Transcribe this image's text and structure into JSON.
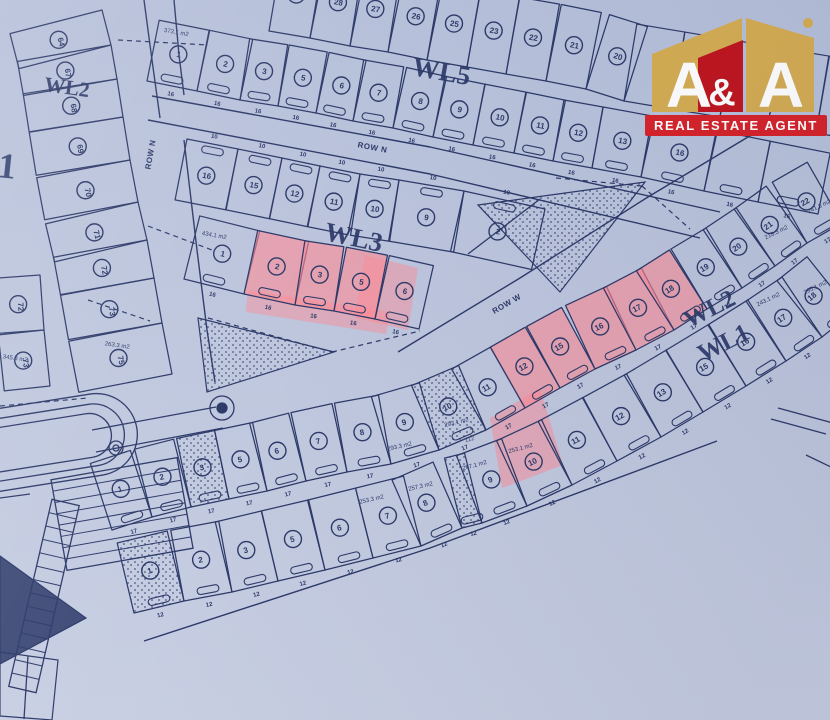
{
  "logo": {
    "a1": "A",
    "amp": "&",
    "a2": "A",
    "banner": "REAL ESTATE AGENT",
    "gold": "#d4ac52",
    "red": "#bf161f",
    "banner_red": "#d6232b",
    "text_color": "#ffffff"
  },
  "map": {
    "bg_top": "#b5bfd9",
    "bg_bottom": "#c8cfe3",
    "ink": "#2d3a69",
    "highlight": "#ff8a94",
    "block_labels": [
      {
        "text": "WL2",
        "x": 66,
        "y": 94,
        "rot": 8,
        "size": 21
      },
      {
        "text": "WL5",
        "x": 440,
        "y": 80,
        "rot": 10,
        "size": 27
      },
      {
        "text": "WL3",
        "x": 352,
        "y": 246,
        "rot": 12,
        "size": 27
      },
      {
        "text": "WL2",
        "x": 713,
        "y": 316,
        "rot": -27,
        "size": 25
      },
      {
        "text": "WL1",
        "x": 727,
        "y": 350,
        "rot": -27,
        "size": 25
      }
    ],
    "misc_labels": [
      {
        "text": "1",
        "x": 6,
        "y": 178,
        "rot": 6,
        "size": 36
      }
    ],
    "road_labels": [
      {
        "text": "ROW N",
        "x": 372,
        "y": 150,
        "rot": 11
      },
      {
        "text": "ROW N",
        "x": 153,
        "y": 155,
        "rot": -80
      },
      {
        "text": "ROW W",
        "x": 508,
        "y": 306,
        "rot": -30
      }
    ],
    "area_labels": [
      {
        "text": "373.1 m2",
        "x": 176,
        "y": 34,
        "rot": 10
      },
      {
        "text": "434.1 m2",
        "x": 214,
        "y": 237,
        "rot": 10
      },
      {
        "text": "293.3 m2",
        "x": 400,
        "y": 448,
        "rot": -13
      },
      {
        "text": "293.1 m2",
        "x": 457,
        "y": 424,
        "rot": -14
      },
      {
        "text": "112",
        "x": 470,
        "y": 441,
        "rot": -14
      },
      {
        "text": "253.3 m2",
        "x": 372,
        "y": 501,
        "rot": -13
      },
      {
        "text": "257.3 m2",
        "x": 421,
        "y": 488,
        "rot": -13
      },
      {
        "text": "257.1 m2",
        "x": 475,
        "y": 467,
        "rot": -15
      },
      {
        "text": "253.1 m2",
        "x": 521,
        "y": 450,
        "rot": -15
      },
      {
        "text": "263.3 m2",
        "x": 117,
        "y": 347,
        "rot": 8
      },
      {
        "text": "345.3 m2",
        "x": 15,
        "y": 360,
        "rot": 8
      },
      {
        "text": "218.3 m2",
        "x": 777,
        "y": 234,
        "rot": -26
      },
      {
        "text": "241.3 m2",
        "x": 820,
        "y": 208,
        "rot": -26
      },
      {
        "text": "295.1 m2",
        "x": 816,
        "y": 289,
        "rot": -26
      },
      {
        "text": "243.1 m2",
        "x": 769,
        "y": 301,
        "rot": -26
      }
    ],
    "rows": [
      {
        "name": "top-row",
        "spine": [
          [
            269,
            31
          ],
          [
            310,
            38
          ],
          [
            350,
            46
          ],
          [
            388,
            52
          ],
          [
            427,
            60
          ],
          [
            467,
            67
          ],
          [
            506,
            74
          ],
          [
            546,
            81
          ],
          [
            586,
            89
          ],
          [
            624,
            101
          ],
          [
            672,
            109
          ],
          [
            720,
            117
          ],
          [
            768,
            125
          ],
          [
            816,
            133
          ],
          [
            862,
            141
          ]
        ],
        "depth": 78,
        "sign": 1,
        "brackets": false,
        "dim": "",
        "nums": [
          "29",
          "28",
          "27",
          "26",
          "25",
          "23",
          "22",
          "21",
          "20",
          "",
          "",
          "",
          "",
          ""
        ],
        "hl": [],
        "st": []
      },
      {
        "name": "wl5-row",
        "spine": [
          [
            147,
            81
          ],
          [
            197,
            91
          ],
          [
            240,
            100
          ],
          [
            278,
            106
          ],
          [
            316,
            113
          ],
          [
            353,
            121
          ],
          [
            393,
            128
          ],
          [
            433,
            137
          ],
          [
            473,
            145
          ],
          [
            514,
            153
          ],
          [
            553,
            161
          ],
          [
            592,
            168
          ],
          [
            641,
            177
          ],
          [
            704,
            191
          ],
          [
            758,
            202
          ],
          [
            818,
            214
          ]
        ],
        "depth": 62,
        "sign": 1,
        "brackets": true,
        "dim": "16",
        "nums": [
          "1",
          "2",
          "3",
          "5",
          "6",
          "7",
          "8",
          "9",
          "10",
          "11",
          "12",
          "13",
          "16",
          "",
          ""
        ],
        "hl": [],
        "st": []
      },
      {
        "name": "wl3-upper",
        "spine": [
          [
            187,
            139
          ],
          [
            238,
            149
          ],
          [
            282,
            158
          ],
          [
            320,
            166
          ],
          [
            360,
            174
          ],
          [
            399,
            180
          ],
          [
            464,
            191
          ],
          [
            545,
            209
          ]
        ],
        "depth": 62,
        "sign": -1,
        "brackets": true,
        "dim": "10",
        "nums": [
          "16",
          "15",
          "12",
          "11",
          "10",
          "9",
          "2"
        ],
        "hl": [],
        "st": []
      },
      {
        "name": "wl3-lower",
        "spine": [
          [
            184,
            279
          ],
          [
            244,
            294
          ],
          [
            295,
            305
          ],
          [
            334,
            311
          ],
          [
            375,
            319
          ],
          [
            419,
            329
          ]
        ],
        "depth": 65,
        "sign": 1,
        "brackets": true,
        "dim": "16",
        "nums": [
          "1",
          "2",
          "3",
          "5",
          "6"
        ],
        "hl": [
          1,
          2,
          3
        ],
        "st": []
      },
      {
        "name": "left-column",
        "spine": [
          [
            102,
            10
          ],
          [
            111,
            45
          ],
          [
            117,
            79
          ],
          [
            123,
            117
          ],
          [
            130,
            160
          ],
          [
            138,
            202
          ],
          [
            147,
            240
          ],
          [
            154,
            278
          ],
          [
            162,
            323
          ],
          [
            172,
            374
          ]
        ],
        "depth": 95,
        "sign": -1,
        "brackets": false,
        "dim": "",
        "nums": [
          "64",
          "67",
          "68",
          "69",
          "70",
          "71",
          "72",
          "73",
          "75"
        ],
        "hl": [],
        "st": []
      },
      {
        "name": "far-left-column",
        "spine": [
          [
            40,
            275
          ],
          [
            44,
            330
          ],
          [
            50,
            386
          ]
        ],
        "depth": 46,
        "sign": -1,
        "brackets": false,
        "dim": "",
        "nums": [
          "72",
          "73"
        ],
        "hl": [],
        "st": []
      },
      {
        "name": "wl2-row",
        "spine": [
          [
            112,
            530
          ],
          [
            152,
            517
          ],
          [
            191,
            507
          ],
          [
            229,
            499
          ],
          [
            267,
            491
          ],
          [
            306,
            481
          ],
          [
            347,
            472
          ],
          [
            391,
            464
          ],
          [
            439,
            450
          ],
          [
            486,
            430
          ],
          [
            525,
            408
          ],
          [
            560,
            388
          ],
          [
            595,
            369
          ],
          [
            636,
            350
          ],
          [
            674,
            330
          ],
          [
            707,
            309
          ],
          [
            742,
            288
          ],
          [
            775,
            266
          ],
          [
            807,
            243
          ],
          [
            842,
            223
          ]
        ],
        "depth": 70,
        "sign": 1,
        "brackets": true,
        "dim": "17",
        "nums": [
          "1",
          "2",
          "3",
          "5",
          "6",
          "7",
          "8",
          "9",
          "10",
          "11",
          "12",
          "15",
          "16",
          "17",
          "18",
          "19",
          "20",
          "21",
          "22"
        ],
        "hl": [
          10,
          11,
          12,
          13,
          14
        ],
        "st": [
          2,
          8
        ]
      },
      {
        "name": "wl1-row",
        "spine": [
          [
            134,
            613
          ],
          [
            184,
            601
          ],
          [
            232,
            592
          ],
          [
            278,
            581
          ],
          [
            325,
            570
          ],
          [
            373,
            558
          ],
          [
            421,
            546
          ],
          [
            462,
            528
          ],
          [
            482,
            523
          ],
          [
            527,
            506
          ],
          [
            572,
            485
          ],
          [
            617,
            461
          ],
          [
            661,
            437
          ],
          [
            703,
            412
          ],
          [
            746,
            386
          ],
          [
            786,
            361
          ],
          [
            822,
            337
          ],
          [
            852,
            313
          ]
        ],
        "depth": 72,
        "sign": 1,
        "brackets": true,
        "dim": "12",
        "nums": [
          "1",
          "2",
          "3",
          "5",
          "6",
          "7",
          "8",
          "",
          "9",
          "10",
          "11",
          "12",
          "13",
          "15",
          "16",
          "17",
          "18"
        ],
        "hl": [],
        "st": [
          0,
          7
        ]
      }
    ],
    "roads": [
      [
        [
          152,
          96
        ],
        [
          430,
          147
        ],
        [
          720,
          212
        ]
      ],
      [
        [
          148,
          120
        ],
        [
          430,
          174
        ],
        [
          700,
          238
        ]
      ],
      [
        [
          144,
          0
        ],
        [
          152,
          60
        ],
        [
          160,
          118
        ]
      ],
      [
        [
          174,
          0
        ],
        [
          179,
          55
        ],
        [
          184,
          95
        ]
      ],
      [
        [
          184,
          140
        ],
        [
          197,
          250
        ],
        [
          207,
          330
        ],
        [
          215,
          382
        ]
      ],
      [
        [
          398,
          352
        ],
        [
          520,
          278
        ],
        [
          648,
          197
        ],
        [
          758,
          131
        ]
      ],
      [
        [
          144,
          641
        ],
        [
          430,
          548
        ],
        [
          717,
          441
        ]
      ]
    ],
    "dashes": [
      [
        [
          118,
          40
        ],
        [
          208,
          45
        ]
      ],
      [
        [
          148,
          226
        ],
        [
          212,
          250
        ]
      ],
      [
        [
          208,
          318
        ],
        [
          332,
          352
        ]
      ],
      [
        [
          332,
          352
        ],
        [
          420,
          331
        ]
      ],
      [
        [
          642,
          186
        ],
        [
          690,
          229
        ]
      ],
      [
        [
          556,
          178
        ],
        [
          642,
          186
        ]
      ],
      [
        [
          0,
          406
        ],
        [
          88,
          398
        ]
      ],
      [
        [
          88,
          300
        ],
        [
          150,
          321
        ]
      ]
    ],
    "stipple_areas": [
      [
        [
          478,
          205
        ],
        [
          645,
          182
        ],
        [
          560,
          292
        ]
      ],
      [
        [
          198,
          318
        ],
        [
          334,
          352
        ],
        [
          207,
          392
        ]
      ]
    ],
    "fringes": [
      {
        "pts": [
          [
            365,
            255
          ],
          [
            418,
            268
          ],
          [
            408,
            330
          ],
          [
            355,
            318
          ]
        ],
        "op": 0.45
      },
      {
        "pts": [
          [
            248,
            290
          ],
          [
            390,
            312
          ],
          [
            386,
            334
          ],
          [
            246,
            312
          ]
        ],
        "op": 0.45
      },
      {
        "pts": [
          [
            490,
            418
          ],
          [
            540,
            388
          ],
          [
            563,
            465
          ],
          [
            502,
            488
          ]
        ],
        "op": 0.5
      }
    ],
    "extra_lines": [
      [
        [
          468,
          254
        ],
        [
          540,
          199
        ]
      ],
      [
        [
          778,
          408
        ],
        [
          833,
          423
        ]
      ],
      [
        [
          771,
          419
        ],
        [
          826,
          434
        ]
      ],
      [
        [
          806,
          455
        ],
        [
          833,
          468
        ]
      ]
    ],
    "bottom_left_shapes": [
      {
        "t": "rrect",
        "x": -52,
        "y": 402,
        "w": 190,
        "h": 82,
        "rx": 41,
        "rot": -9
      },
      {
        "t": "rrect",
        "x": -40,
        "y": 412,
        "w": 165,
        "h": 62,
        "rx": 31,
        "rot": -9
      },
      {
        "t": "rrect",
        "x": -28,
        "y": 421,
        "w": 140,
        "h": 44,
        "rx": 22,
        "rot": -9
      },
      {
        "t": "circle",
        "cx": 116,
        "cy": 448,
        "r": 7
      },
      {
        "t": "circle",
        "cx": 116,
        "cy": 448,
        "r": 3
      },
      {
        "t": "circle",
        "cx": 222,
        "cy": 408,
        "r": 12
      },
      {
        "t": "circle",
        "cx": 222,
        "cy": 408,
        "r": 5,
        "f": 1
      },
      {
        "t": "ladder",
        "x": 58,
        "y": 468,
        "w": 128,
        "h": 92,
        "rot": -10,
        "n": 7
      },
      {
        "t": "ladder",
        "x": 30,
        "y": 500,
        "w": 28,
        "h": 192,
        "rot": 13,
        "n": 13
      },
      {
        "t": "poly",
        "pts": [
          [
            0,
            556
          ],
          [
            86,
            618
          ],
          [
            0,
            664
          ]
        ],
        "f": 1
      },
      {
        "t": "line",
        "pts": [
          [
            92,
            430
          ],
          [
            216,
            407
          ]
        ]
      },
      {
        "t": "line",
        "pts": [
          [
            96,
            452
          ],
          [
            223,
            428
          ]
        ]
      },
      {
        "t": "line",
        "pts": [
          [
            0,
            498
          ],
          [
            30,
            494
          ]
        ]
      },
      {
        "t": "poly",
        "pts": [
          [
            0,
            652
          ],
          [
            58,
            660
          ],
          [
            52,
            720
          ],
          [
            0,
            716
          ]
        ]
      },
      {
        "t": "line",
        "pts": [
          [
            28,
            656
          ],
          [
            24,
            719
          ]
        ]
      }
    ]
  }
}
